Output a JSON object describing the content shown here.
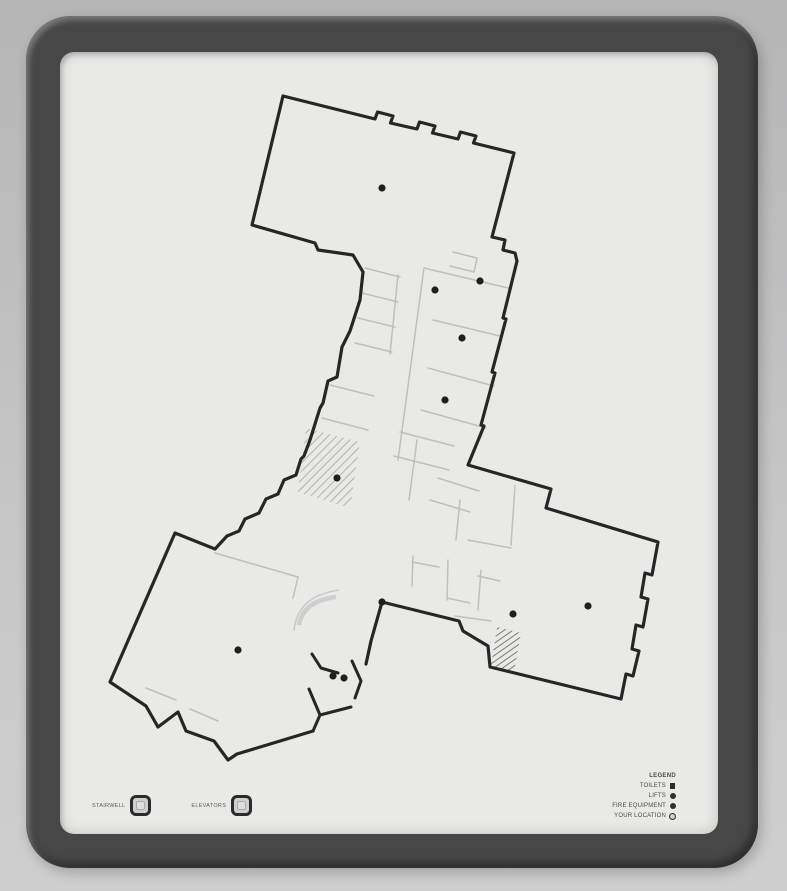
{
  "colors": {
    "wall": "#c4c4c5",
    "frame": "#474747",
    "panel": "#e9e9e8",
    "wall_line": "#262626",
    "partition": "#b4b4b4",
    "hatch_light": "#8f8f8f",
    "hatch_dark": "#4f4f4f",
    "marker": "#1f1f1f",
    "legend_text": "#4a4a4a"
  },
  "legend": {
    "title": "LEGEND",
    "items": [
      {
        "label": "TOILETS",
        "symbol": "filled-square"
      },
      {
        "label": "LIFTS",
        "symbol": "filled-circle"
      },
      {
        "label": "FIRE EQUIPMENT",
        "symbol": "filled-circle"
      },
      {
        "label": "YOUR LOCATION",
        "symbol": "open-circle"
      }
    ]
  },
  "footer_keys": {
    "items": [
      {
        "label": "STAIRWELL"
      },
      {
        "label": "ELEVATORS"
      }
    ]
  },
  "plan": {
    "markers": [
      [
        382,
        188
      ],
      [
        435,
        290
      ],
      [
        480,
        281
      ],
      [
        462,
        338
      ],
      [
        445,
        400
      ],
      [
        337,
        478
      ],
      [
        238,
        650
      ],
      [
        382,
        602
      ],
      [
        513,
        614
      ],
      [
        588,
        606
      ],
      [
        333,
        676
      ],
      [
        344,
        678
      ]
    ]
  }
}
